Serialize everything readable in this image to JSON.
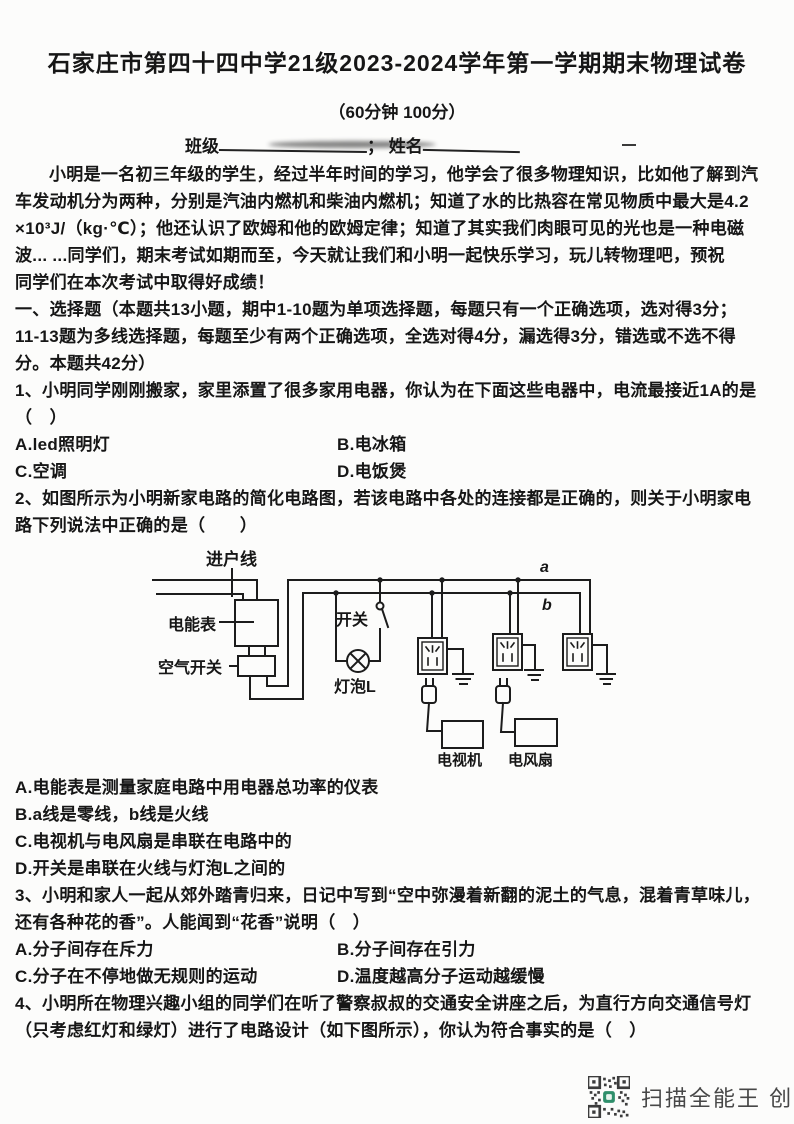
{
  "header": {
    "title": "石家庄市第四十四中学21级2023-2024学年第一学期期末物理试卷",
    "duration_score": "（60分钟 100分）",
    "class_label": "班级",
    "separator": "；",
    "name_label": "姓名"
  },
  "intro": {
    "lines": [
      "小明是一名初三年级的学生，经过半年时间的学习，他学会了很多物理知识，比如他了解到汽",
      "车发动机分为两种，分别是汽油内燃机和柴油内燃机；知道了水的比热容在常见物质中最大是4.2",
      "×10³J/（kg·℃）；他还认识了欧姆和他的欧姆定律；知道了其实我们肉眼可见的光也是一种电磁",
      "波... ...同学们，期末考试如期而至，今天就让我们和小明一起快乐学习，玩儿转物理吧，预祝",
      "同学们在本次考试中取得好成绩！"
    ]
  },
  "section_one": {
    "lines": [
      "一、选择题（本题共13小题，期中1-10题为单项选择题，每题只有一个正确选项，选对得3分；",
      "11-13题为多线选择题，每题至少有两个正确选项，全选对得4分，漏选得3分，错选或不选不得",
      "分。本题共42分）"
    ]
  },
  "q1": {
    "lines": [
      "1、小明同学刚刚搬家，家里添置了很多家用电器，你认为在下面这些电器中，电流最接近1A的是",
      "（　）"
    ],
    "options": [
      "A.led照明灯",
      "B.电冰箱",
      "C.空调",
      "D.电饭煲"
    ]
  },
  "q2": {
    "lines": [
      "2、如图所示为小明新家电路的简化电路图，若该电路中各处的连接都是正确的，则关于小明家电",
      "路下列说法中正确的是（　　）"
    ],
    "options": [
      "A.电能表是测量家庭电路中用电器总功率的仪表",
      "B.a线是零线，b线是火线",
      "C.电视机与电风扇是串联在电路中的",
      "D.开关是串联在火线与灯泡L之间的"
    ]
  },
  "diagram": {
    "incoming_line": "进户线",
    "energy_meter": "电能表",
    "air_switch": "空气开关",
    "switch": "开关",
    "bulb": "灯泡L",
    "wire_a": "a",
    "wire_b": "b",
    "tv": "电视机",
    "fan": "电风扇"
  },
  "q3": {
    "lines": [
      "3、小明和家人一起从郊外踏青归来，日记中写到“空中弥漫着新翻的泥土的气息，混着青草味儿，",
      "还有各种花的香”。人能闻到“花香”说明（　）"
    ],
    "options": [
      "A.分子间存在斥力",
      "B.分子间存在引力",
      "C.分子在不停地做无规则的运动",
      "D.温度越高分子运动越缓慢"
    ]
  },
  "q4": {
    "lines": [
      "4、小明所在物理兴趣小组的同学们在听了警察叔叔的交通安全讲座之后，为直行方向交通信号灯",
      "（只考虑红灯和绿灯）进行了电路设计（如下图所示），你认为符合事实的是（　）"
    ]
  },
  "footer": {
    "watermark": "扫描全能王 创建"
  }
}
